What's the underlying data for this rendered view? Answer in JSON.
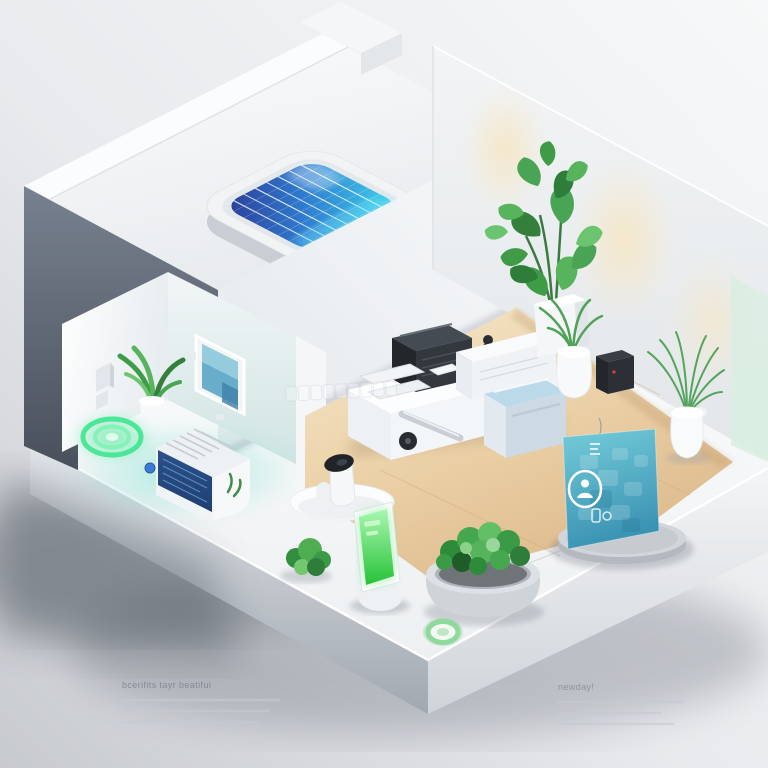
{
  "meta": {
    "title": "Isometric 3D smart-home cutaway illustration",
    "style": "soft white minimal 3D render"
  },
  "captions": {
    "left": {
      "title": "bcerifits tayr beatiful",
      "line_count": 3
    },
    "right": {
      "title": "newday!",
      "line_count": 3
    }
  },
  "watermark": {
    "legible": false,
    "box_count": 9
  },
  "scene": {
    "objects": [
      "solar-panel-roof",
      "dark-exterior-wall",
      "right-wall-with-downlights",
      "wood-floor",
      "alcove-room",
      "green-charging-rings",
      "smart-heater-unit",
      "wall-mounted-screen-frame",
      "potted-plant-alcove",
      "desk-with-printer",
      "blue-top-appliance",
      "robot-camera-on-rug",
      "smart-info-card-panel",
      "pedestal-disc",
      "green-screen-kiosk",
      "round-shrub-planter",
      "green-ring-badge",
      "tall-leafy-plant",
      "palm-plant-small",
      "palm-plant-right",
      "black-coffee-machine",
      "white-platform-base"
    ]
  },
  "colors": {
    "bg-light": "#f4f6f7",
    "bg-dark": "#c7cacf",
    "dark-wall-top": "#78818f",
    "dark-wall-bottom": "#49505b",
    "panel-indigo": "#2c3a96",
    "panel-blue": "#2f7bd0",
    "panel-cyan": "#3fd6ec",
    "wood-light": "#f6e8cc",
    "wood-dark": "#ddba8c",
    "glow-warm": "#f6e7c6",
    "ring-green": "#45e695",
    "badge-green": "#8fd99b",
    "kiosk-green-top": "#a9f7b0",
    "kiosk-green": "#27c238",
    "card-teal-top": "#74ccd9",
    "card-teal-bottom": "#3b93b4",
    "appliance-navy": "#1f3f74",
    "plant-green": "#3f9b46",
    "plant-dark": "#2e7d3a",
    "mint": "#d9efe3"
  }
}
